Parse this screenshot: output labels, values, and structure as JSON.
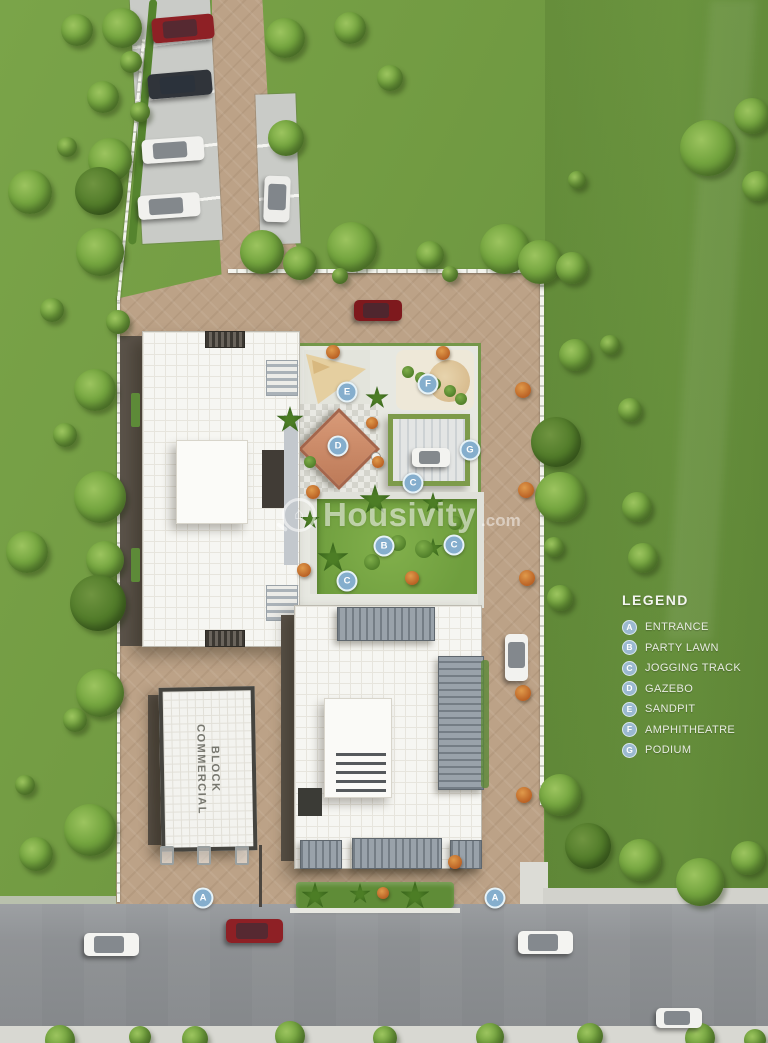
{
  "legend": {
    "title": "LEGEND",
    "items": [
      {
        "key": "A",
        "label": "ENTRANCE"
      },
      {
        "key": "B",
        "label": "PARTY LAWN"
      },
      {
        "key": "C",
        "label": "JOGGING TRACK"
      },
      {
        "key": "D",
        "label": "GAZEBO"
      },
      {
        "key": "E",
        "label": "SANDPIT"
      },
      {
        "key": "F",
        "label": "AMPHITHEATRE"
      },
      {
        "key": "G",
        "label": "PODIUM"
      }
    ]
  },
  "watermark": {
    "name": "Housivity",
    "tld": ".com",
    "icon": "magnifier-house-icon"
  },
  "buildings": {
    "commercial_label": "COMMERCIAL BLOCK"
  },
  "plan": {
    "markers": [
      {
        "key": "A",
        "x": 203,
        "y": 898
      },
      {
        "key": "A",
        "x": 495,
        "y": 898
      },
      {
        "key": "B",
        "x": 384,
        "y": 546
      },
      {
        "key": "C",
        "x": 413,
        "y": 483
      },
      {
        "key": "C",
        "x": 454,
        "y": 545
      },
      {
        "key": "C",
        "x": 347,
        "y": 581
      },
      {
        "key": "D",
        "x": 338,
        "y": 446
      },
      {
        "key": "E",
        "x": 347,
        "y": 392
      },
      {
        "key": "F",
        "x": 428,
        "y": 384
      },
      {
        "key": "G",
        "x": 470,
        "y": 450
      }
    ]
  },
  "colors": {
    "grass": "#6f9a42",
    "paver": "#bca287",
    "road": "#8d9093",
    "marker_blue": "#85aecd",
    "gazebo_terracotta": "#c9886a",
    "legend_text": "#e8ece2"
  }
}
